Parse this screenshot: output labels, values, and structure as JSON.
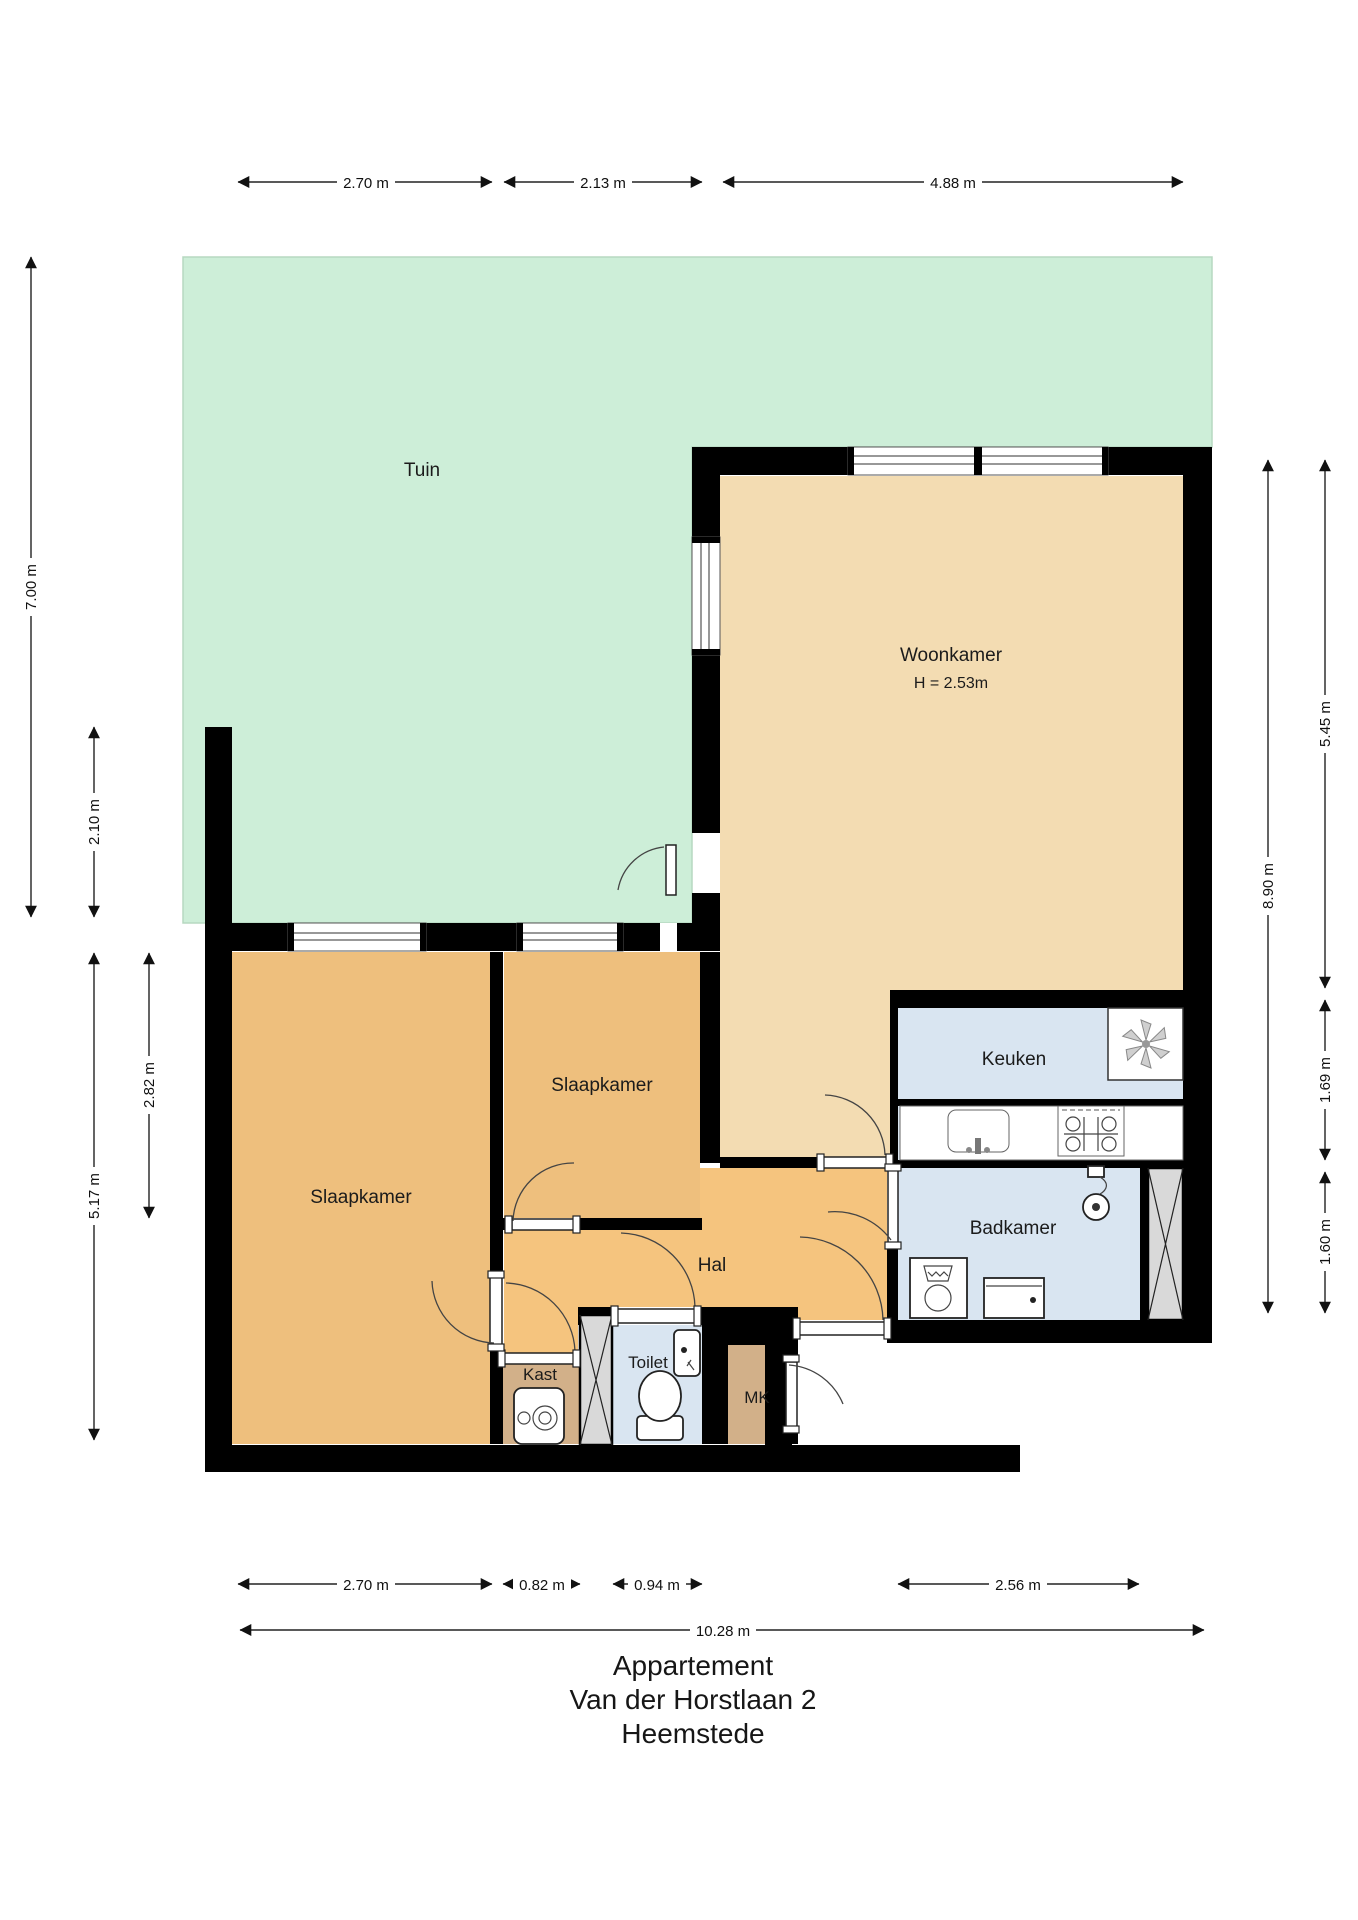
{
  "title": {
    "building": "Appartement",
    "address": "Van der Horstlaan 2",
    "city": "Heemstede"
  },
  "rooms": {
    "tuin": {
      "label": "Tuin"
    },
    "woonkamer": {
      "label": "Woonkamer",
      "ceiling_height": "H = 2.53m"
    },
    "slaapkamer_groot": {
      "label": "Slaapkamer"
    },
    "slaapkamer_klein": {
      "label": "Slaapkamer"
    },
    "hal": {
      "label": "Hal"
    },
    "keuken": {
      "label": "Keuken"
    },
    "badkamer": {
      "label": "Badkamer"
    },
    "toilet": {
      "label": "Toilet"
    },
    "kast": {
      "label": "Kast"
    },
    "mk": {
      "label": "MK"
    }
  },
  "dimensions": {
    "top": [
      "2.70 m",
      "2.13 m",
      "4.88 m"
    ],
    "left": [
      "7.00 m",
      "2.10 m",
      "5.17 m",
      "2.82 m"
    ],
    "right": [
      "8.90 m",
      "5.45 m",
      "1.69 m",
      "1.60 m"
    ],
    "bottom": [
      "2.70 m",
      "0.82 m",
      "0.94 m",
      "2.56 m"
    ],
    "overall_width": "10.28 m"
  },
  "icons": {
    "ventilation": "fan-icon",
    "boiler": "boiler-icon",
    "wc": "toilet-icon",
    "shower": "shower-icon",
    "washer": "washing-machine-icon",
    "sink": "sink-icon",
    "stove": "stove-icon"
  },
  "colors": {
    "garden": "#cdeed8",
    "living_room": "#f3dcb2",
    "bedroom": "#eebf7d",
    "hall": "#f5c47e",
    "wet_rooms": "#d9e5f1",
    "closets": "#d2b089",
    "walls": "#000000",
    "shaft": "#d9d9d9"
  }
}
